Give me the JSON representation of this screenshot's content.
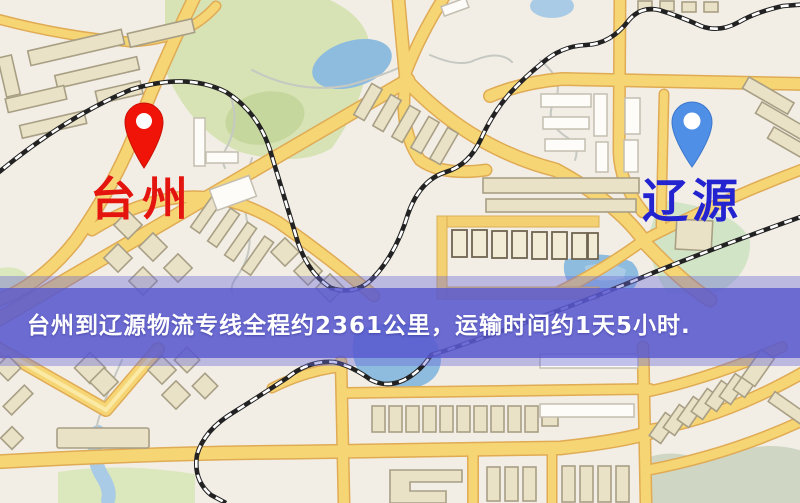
{
  "map": {
    "origin": {
      "label": "台州",
      "pin_color": "#f01408",
      "label_color": "#e3150e",
      "pin": "red-location-pin"
    },
    "destination": {
      "label": "辽源",
      "pin_color": "#4f8fe6",
      "label_color": "#2323cf",
      "pin": "blue-location-pin"
    },
    "banner": {
      "text": "台州到辽源物流专线全程约2361公里，运输时间约1天5小时.",
      "route": {
        "from": "台州",
        "to": "辽源",
        "service": "物流专线",
        "distance_km": "2361",
        "duration": "1天5小时"
      },
      "background": "rgba(88,88,206,0.8)",
      "glow": "rgba(106,106,216,0.4)",
      "text_color": "#ffffff"
    },
    "theme": {
      "road": "#f6d574",
      "road-casing": "#e0ab55",
      "water": "#8ebcdf",
      "park": "#d7e3b4",
      "building": "#eae2c6",
      "railway": "#222222",
      "bg": "#f2eee6",
      "banner": "rgba(88,88,206,0.8)",
      "banner-glow": "rgba(106,106,216,0.4)",
      "pin-origin": "#f01408",
      "pin-dest": "#4f8fe6",
      "label-origin": "#e3150e",
      "label-dest": "#2323cf",
      "banner-text": "#ffffff"
    }
  }
}
